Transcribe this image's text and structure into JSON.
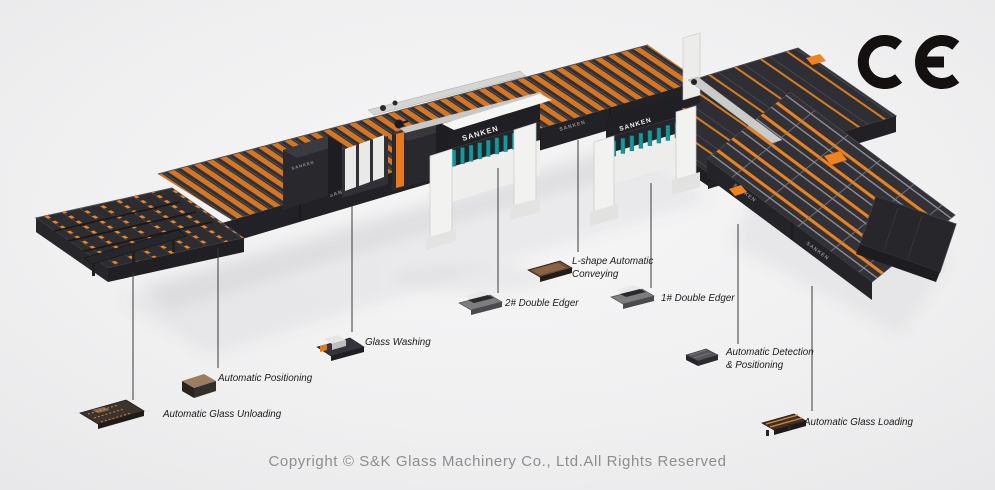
{
  "brand": {
    "machine_label": "SANKEN"
  },
  "ce_mark": {
    "text": "CE"
  },
  "callouts": [
    {
      "line1": "Automatic Glass Unloading",
      "line2": ""
    },
    {
      "line1": "Automatic Positioning",
      "line2": ""
    },
    {
      "line1": "Glass Washing",
      "line2": ""
    },
    {
      "line1": "2# Double Edger",
      "line2": ""
    },
    {
      "line1": "L-shape Automatic",
      "line2": "Conveying"
    },
    {
      "line1": "1# Double Edger",
      "line2": ""
    },
    {
      "line1": "Automatic Detection",
      "line2": "& Positioning"
    },
    {
      "line1": "Automatic Glass Loading",
      "line2": ""
    }
  ],
  "footer": {
    "copyright": "Copyright © S&K Glass Machinery Co., Ltd.All Rights Reserved"
  },
  "colors": {
    "background": "#EFEFF0",
    "machine_dark": "#2E2E34",
    "accent_orange": "#ED7E20",
    "edger_white": "#F2F2F0",
    "spindle_teal": "#139B9B",
    "ce_black": "#141010",
    "copyright_gray": "#8E8E8E"
  }
}
